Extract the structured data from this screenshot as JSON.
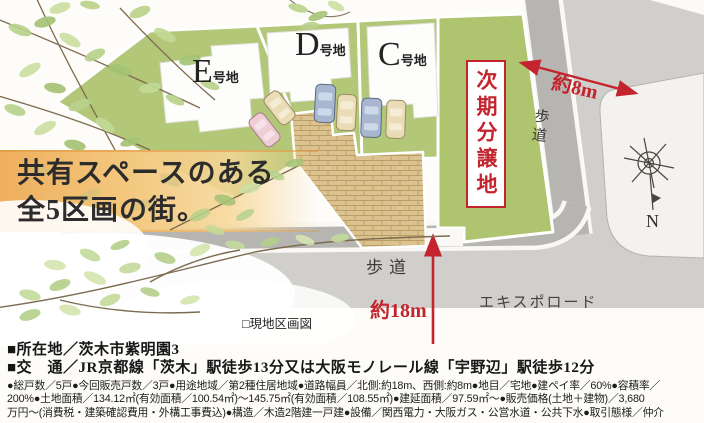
{
  "headline": {
    "line1": "共有スペースのある",
    "line2": "全5区画の街。"
  },
  "site_plan": {
    "lots": [
      {
        "letter": "E",
        "suffix": "号地"
      },
      {
        "letter": "D",
        "suffix": "号地"
      },
      {
        "letter": "C",
        "suffix": "号地"
      }
    ],
    "next_phase_label": "次期分譲地",
    "sidewalk_right": "歩道",
    "sidewalk_bottom": "歩道",
    "road_name": "エキスポロード",
    "road_width_east": "約8m",
    "road_width_south": "約18m",
    "compass_north": "N",
    "caption": "□現地区画図"
  },
  "details": {
    "location": "■所在地／茨木市紫明園3",
    "access": "■交　通／JR京都線「茨木」駅徒歩13分又は大阪モノレール線「宇野辺」駅徒歩12分",
    "spec_lines": [
      "●総戸数／5戸●今回販売戸数／3戸●用途地域／第2種住居地域●道路幅員／北側:約18m、西側:約8m●地目／宅地●建ペイ率／60%●容積率／",
      "200%●土地面積／134.12㎡(有効面積／100.54㎡)～145.75㎡(有効面積／108.55㎡)●建延面積／97.59㎡～●販売価格(土地＋建物)／3,680",
      "万円～(消費税・建築確認費用・外構工事費込)●構造／木造2階建一戸建●設備／関西電力・大阪ガス・公営水道・公共下水●取引態様／仲介"
    ]
  },
  "colors": {
    "accent_red": "#c3242e",
    "lawn_green": "#b2c778",
    "brick_tan": "#d9be8a",
    "road_gray": "#d0cfcb",
    "sidewalk_gray": "#b6b5b1",
    "band_orange": "#f0b464"
  }
}
